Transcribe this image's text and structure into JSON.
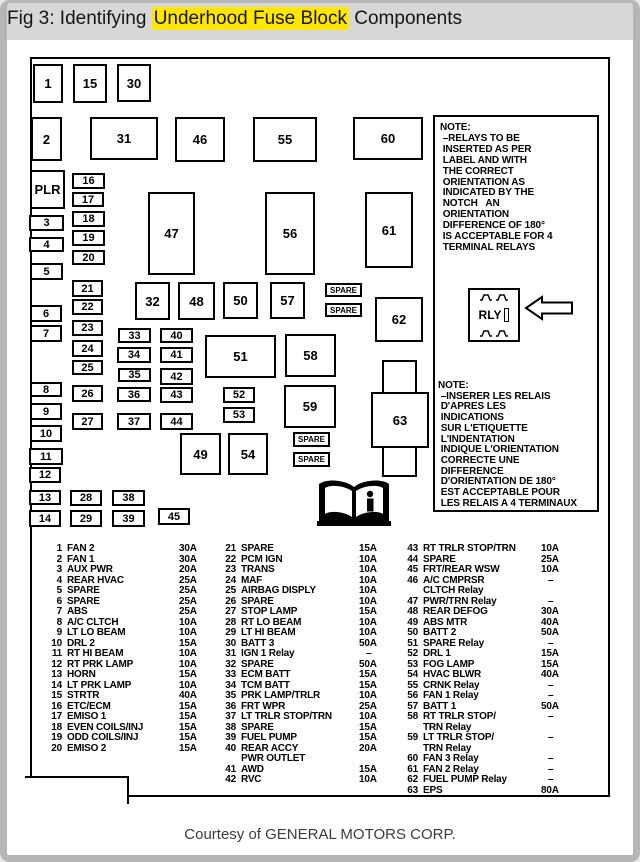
{
  "title": {
    "prefix": "Fig 3: Identifying ",
    "highlight": "Underhood Fuse Block",
    "suffix": " Components"
  },
  "caption": "Courtesy of GENERAL MOTORS CORP.",
  "diagram": {
    "spare_label": "SPARE",
    "rly_label": "RLY",
    "note_en": "NOTE:\n –RELAYS TO BE\n INSERTED AS PER\n LABEL AND WITH\n THE CORRECT\n ORIENTATION AS\n INDICATED BY THE\n NOTCH   AN\n ORIENTATION\n DIFFERENCE OF 180°\n IS ACCEPTABLE FOR 4\n TERMINAL RELAYS",
    "note_fr": "NOTE:\n –INSERER LES RELAIS\n D'APRES LES\n INDICATIONS\n SUR L'ETIQUETTE\n L'INDENTATION\n INDIQUE L'ORIENTATION\n CORRECTE UNE\n DIFFERENCE\n D'ORIENTATION DE 180°\n EST ACCEPTABLE POUR\n LES RELAIS A 4 TERMINAUX",
    "cross_box_label": "63",
    "boxes": [
      {
        "label": "1",
        "x": 33,
        "y": 64,
        "w": 30,
        "h": 39
      },
      {
        "label": "15",
        "x": 73,
        "y": 64,
        "w": 34,
        "h": 39
      },
      {
        "label": "30",
        "x": 117,
        "y": 64,
        "w": 34,
        "h": 38
      },
      {
        "label": "2",
        "x": 31,
        "y": 117,
        "w": 31,
        "h": 44
      },
      {
        "label": "31",
        "x": 90,
        "y": 117,
        "w": 68,
        "h": 43
      },
      {
        "label": "46",
        "x": 175,
        "y": 117,
        "w": 50,
        "h": 45
      },
      {
        "label": "55",
        "x": 253,
        "y": 117,
        "w": 64,
        "h": 45
      },
      {
        "label": "60",
        "x": 353,
        "y": 117,
        "w": 70,
        "h": 43
      },
      {
        "label": "PLR",
        "x": 30,
        "y": 170,
        "w": 35,
        "h": 39
      },
      {
        "label": "16",
        "x": 72,
        "y": 173,
        "w": 33,
        "h": 16
      },
      {
        "label": "17",
        "x": 72,
        "y": 192,
        "w": 32,
        "h": 15
      },
      {
        "label": "18",
        "x": 72,
        "y": 211,
        "w": 33,
        "h": 16
      },
      {
        "label": "19",
        "x": 72,
        "y": 230,
        "w": 33,
        "h": 16
      },
      {
        "label": "20",
        "x": 72,
        "y": 250,
        "w": 33,
        "h": 15
      },
      {
        "label": "3",
        "x": 29,
        "y": 215,
        "w": 35,
        "h": 16
      },
      {
        "label": "4",
        "x": 29,
        "y": 237,
        "w": 35,
        "h": 15
      },
      {
        "label": "5",
        "x": 30,
        "y": 263,
        "w": 33,
        "h": 17
      },
      {
        "label": "47",
        "x": 148,
        "y": 192,
        "w": 47,
        "h": 83
      },
      {
        "label": "56",
        "x": 265,
        "y": 192,
        "w": 50,
        "h": 83
      },
      {
        "label": "61",
        "x": 365,
        "y": 192,
        "w": 48,
        "h": 76
      },
      {
        "label": "21",
        "x": 72,
        "y": 280,
        "w": 31,
        "h": 17
      },
      {
        "label": "22",
        "x": 72,
        "y": 299,
        "w": 31,
        "h": 16
      },
      {
        "label": "23",
        "x": 72,
        "y": 320,
        "w": 31,
        "h": 16
      },
      {
        "label": "24",
        "x": 72,
        "y": 340,
        "w": 31,
        "h": 17
      },
      {
        "label": "25",
        "x": 72,
        "y": 360,
        "w": 31,
        "h": 15
      },
      {
        "label": "26",
        "x": 72,
        "y": 385,
        "w": 31,
        "h": 17
      },
      {
        "label": "27",
        "x": 72,
        "y": 413,
        "w": 31,
        "h": 17
      },
      {
        "label": "6",
        "x": 30,
        "y": 305,
        "w": 32,
        "h": 17
      },
      {
        "label": "7",
        "x": 30,
        "y": 325,
        "w": 32,
        "h": 17
      },
      {
        "label": "8",
        "x": 30,
        "y": 382,
        "w": 32,
        "h": 15
      },
      {
        "label": "9",
        "x": 30,
        "y": 403,
        "w": 32,
        "h": 17
      },
      {
        "label": "10",
        "x": 30,
        "y": 425,
        "w": 32,
        "h": 17
      },
      {
        "label": "32",
        "x": 135,
        "y": 282,
        "w": 35,
        "h": 38
      },
      {
        "label": "48",
        "x": 178,
        "y": 282,
        "w": 37,
        "h": 38
      },
      {
        "label": "50",
        "x": 223,
        "y": 282,
        "w": 35,
        "h": 37
      },
      {
        "label": "57",
        "x": 270,
        "y": 282,
        "w": 35,
        "h": 37
      },
      {
        "label": "62",
        "x": 375,
        "y": 297,
        "w": 48,
        "h": 45
      },
      {
        "label": "33",
        "x": 118,
        "y": 328,
        "w": 33,
        "h": 15
      },
      {
        "label": "34",
        "x": 117,
        "y": 347,
        "w": 34,
        "h": 16
      },
      {
        "label": "35",
        "x": 118,
        "y": 368,
        "w": 33,
        "h": 14
      },
      {
        "label": "36",
        "x": 117,
        "y": 387,
        "w": 34,
        "h": 15
      },
      {
        "label": "37",
        "x": 117,
        "y": 413,
        "w": 34,
        "h": 17
      },
      {
        "label": "40",
        "x": 160,
        "y": 328,
        "w": 33,
        "h": 15
      },
      {
        "label": "41",
        "x": 160,
        "y": 347,
        "w": 33,
        "h": 16
      },
      {
        "label": "42",
        "x": 160,
        "y": 368,
        "w": 33,
        "h": 17
      },
      {
        "label": "43",
        "x": 160,
        "y": 387,
        "w": 33,
        "h": 16
      },
      {
        "label": "44",
        "x": 160,
        "y": 413,
        "w": 33,
        "h": 17
      },
      {
        "label": "51",
        "x": 205,
        "y": 335,
        "w": 71,
        "h": 43
      },
      {
        "label": "58",
        "x": 285,
        "y": 334,
        "w": 51,
        "h": 43
      },
      {
        "label": "52",
        "x": 223,
        "y": 387,
        "w": 32,
        "h": 16
      },
      {
        "label": "53",
        "x": 223,
        "y": 407,
        "w": 32,
        "h": 16
      },
      {
        "label": "59",
        "x": 284,
        "y": 385,
        "w": 52,
        "h": 43
      },
      {
        "label": "49",
        "x": 180,
        "y": 433,
        "w": 41,
        "h": 42
      },
      {
        "label": "54",
        "x": 228,
        "y": 433,
        "w": 40,
        "h": 42
      },
      {
        "label": "11",
        "x": 29,
        "y": 448,
        "w": 34,
        "h": 17
      },
      {
        "label": "12",
        "x": 29,
        "y": 467,
        "w": 32,
        "h": 16
      },
      {
        "label": "13",
        "x": 29,
        "y": 490,
        "w": 32,
        "h": 15
      },
      {
        "label": "14",
        "x": 29,
        "y": 510,
        "w": 32,
        "h": 17
      },
      {
        "label": "28",
        "x": 70,
        "y": 490,
        "w": 32,
        "h": 16
      },
      {
        "label": "29",
        "x": 70,
        "y": 510,
        "w": 32,
        "h": 17
      },
      {
        "label": "38",
        "x": 112,
        "y": 490,
        "w": 33,
        "h": 16
      },
      {
        "label": "39",
        "x": 112,
        "y": 510,
        "w": 33,
        "h": 17
      },
      {
        "label": "45",
        "x": 158,
        "y": 508,
        "w": 32,
        "h": 17
      }
    ],
    "spares": [
      {
        "x": 325,
        "y": 283,
        "w": 37,
        "h": 14
      },
      {
        "x": 325,
        "y": 303,
        "w": 37,
        "h": 14
      },
      {
        "x": 293,
        "y": 432,
        "w": 37,
        "h": 15
      },
      {
        "x": 293,
        "y": 452,
        "w": 37,
        "h": 15
      }
    ]
  },
  "legend": {
    "columns": [
      [
        {
          "num": "1",
          "name": "FAN 2",
          "amp": "30A"
        },
        {
          "num": "2",
          "name": "FAN 1",
          "amp": "30A"
        },
        {
          "num": "3",
          "name": "AUX PWR",
          "amp": "20A"
        },
        {
          "num": "4",
          "name": "REAR HVAC",
          "amp": "25A"
        },
        {
          "num": "5",
          "name": "SPARE",
          "amp": "25A"
        },
        {
          "num": "6",
          "name": "SPARE",
          "amp": "25A"
        },
        {
          "num": "7",
          "name": "ABS",
          "amp": "25A"
        },
        {
          "num": "8",
          "name": "A/C CLTCH",
          "amp": "10A"
        },
        {
          "num": "9",
          "name": "LT LO BEAM",
          "amp": "10A"
        },
        {
          "num": "10",
          "name": "DRL 2",
          "amp": "15A"
        },
        {
          "num": "11",
          "name": "RT HI BEAM",
          "amp": "10A"
        },
        {
          "num": "12",
          "name": "RT PRK LAMP",
          "amp": "10A"
        },
        {
          "num": "13",
          "name": "HORN",
          "amp": "15A"
        },
        {
          "num": "14",
          "name": "LT PRK LAMP",
          "amp": "10A"
        },
        {
          "num": "15",
          "name": "STRTR",
          "amp": "40A"
        },
        {
          "num": "16",
          "name": "ETC/ECM",
          "amp": "15A"
        },
        {
          "num": "17",
          "name": "EMISO 1",
          "amp": "15A"
        },
        {
          "num": "18",
          "name": "EVEN COILS/INJ",
          "amp": "15A"
        },
        {
          "num": "19",
          "name": "ODD COILS/INJ",
          "amp": "15A"
        },
        {
          "num": "20",
          "name": "EMISO 2",
          "amp": "15A"
        }
      ],
      [
        {
          "num": "21",
          "name": "SPARE",
          "amp": "15A"
        },
        {
          "num": "22",
          "name": "PCM IGN",
          "amp": "10A"
        },
        {
          "num": "23",
          "name": "TRANS",
          "amp": "10A"
        },
        {
          "num": "24",
          "name": "MAF",
          "amp": "10A"
        },
        {
          "num": "25",
          "name": "AIRBAG DISPLY",
          "amp": "10A"
        },
        {
          "num": "26",
          "name": "SPARE",
          "amp": "10A"
        },
        {
          "num": "27",
          "name": "STOP LAMP",
          "amp": "15A"
        },
        {
          "num": "28",
          "name": "RT LO BEAM",
          "amp": "10A"
        },
        {
          "num": "29",
          "name": "LT HI BEAM",
          "amp": "10A"
        },
        {
          "num": "30",
          "name": "BATT 3",
          "amp": "50A"
        },
        {
          "num": "31",
          "name": "IGN 1 Relay",
          "amp": "–"
        },
        {
          "num": "32",
          "name": "SPARE",
          "amp": "50A"
        },
        {
          "num": "33",
          "name": "ECM BATT",
          "amp": "15A"
        },
        {
          "num": "34",
          "name": "TCM BATT",
          "amp": "15A"
        },
        {
          "num": "35",
          "name": "PRK LAMP/TRLR",
          "amp": "10A"
        },
        {
          "num": "36",
          "name": "FRT WPR",
          "amp": "25A"
        },
        {
          "num": "37",
          "name": "LT TRLR STOP/TRN",
          "amp": "10A"
        },
        {
          "num": "38",
          "name": "SPARE",
          "amp": "15A"
        },
        {
          "num": "39",
          "name": "FUEL PUMP",
          "amp": "15A"
        },
        {
          "num": "40",
          "name": "REAR ACCY\nPWR OUTLET",
          "amp": "20A"
        },
        {
          "num": "41",
          "name": "AWD",
          "amp": "15A"
        },
        {
          "num": "42",
          "name": "RVC",
          "amp": "10A"
        }
      ],
      [
        {
          "num": "43",
          "name": "RT TRLR STOP/TRN",
          "amp": "10A"
        },
        {
          "num": "44",
          "name": "SPARE",
          "amp": "25A"
        },
        {
          "num": "45",
          "name": "FRT/REAR WSW",
          "amp": "10A"
        },
        {
          "num": "46",
          "name": "A/C CMPRSR\nCLTCH Relay",
          "amp": "–"
        },
        {
          "num": "47",
          "name": "PWR/TRN Relay",
          "amp": "–"
        },
        {
          "num": "48",
          "name": "REAR DEFOG",
          "amp": "30A"
        },
        {
          "num": "49",
          "name": "ABS MTR",
          "amp": "40A"
        },
        {
          "num": "50",
          "name": "BATT 2",
          "amp": "50A"
        },
        {
          "num": "51",
          "name": "SPARE Relay",
          "amp": "–"
        },
        {
          "num": "52",
          "name": "DRL 1",
          "amp": "15A"
        },
        {
          "num": "53",
          "name": "FOG LAMP",
          "amp": "15A"
        },
        {
          "num": "54",
          "name": "HVAC BLWR",
          "amp": "40A"
        },
        {
          "num": "55",
          "name": "CRNK Relay",
          "amp": "–"
        },
        {
          "num": "56",
          "name": "FAN 1 Relay",
          "amp": "–"
        },
        {
          "num": "57",
          "name": "BATT 1",
          "amp": "50A"
        },
        {
          "num": "58",
          "name": "RT TRLR STOP/\nTRN Relay",
          "amp": "–"
        },
        {
          "num": "59",
          "name": "LT TRLR STOP/\nTRN Relay",
          "amp": "–"
        },
        {
          "num": "60",
          "name": "FAN 3 Relay",
          "amp": "–"
        },
        {
          "num": "61",
          "name": "FAN 2 Relay",
          "amp": "–"
        },
        {
          "num": "62",
          "name": "FUEL PUMP Relay",
          "amp": "–"
        },
        {
          "num": "63",
          "name": "EPS",
          "amp": "80A"
        }
      ]
    ]
  }
}
